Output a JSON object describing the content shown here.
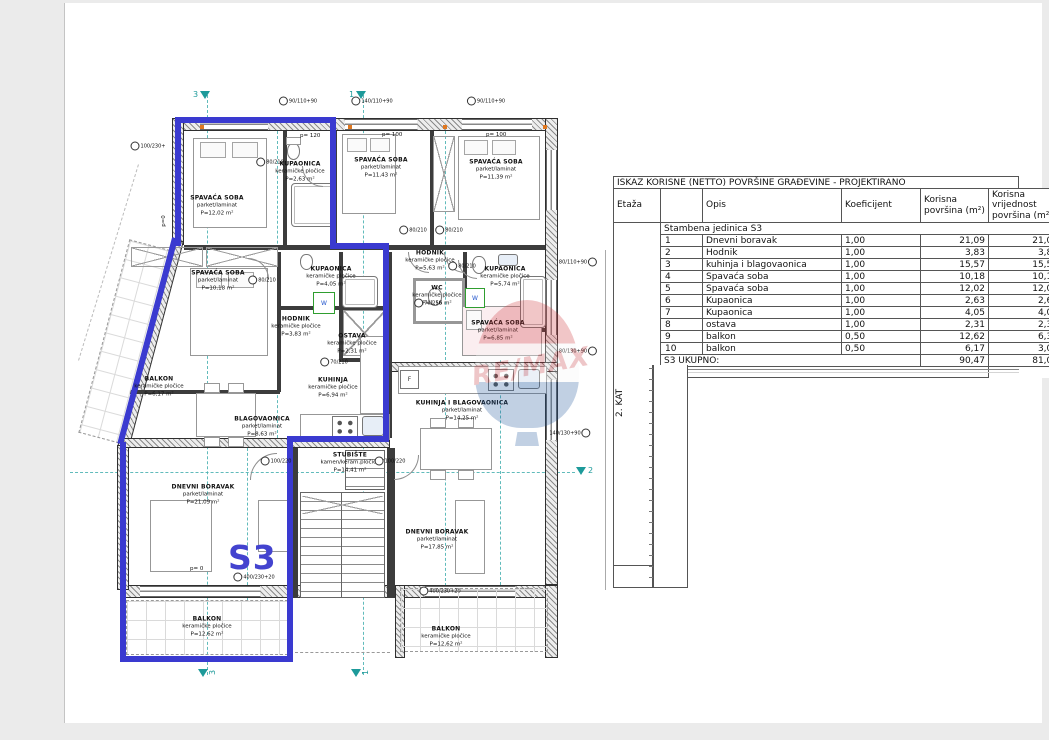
{
  "plan": {
    "unit_label": "S3",
    "markers": {
      "n3": "3",
      "n1": "1",
      "n2": "2"
    },
    "watermark": {
      "text": "RE/MAX"
    },
    "appliances": {
      "washer": "W",
      "fridge": "F"
    },
    "rooms": [
      {
        "name": "SPAVAĆA SOBA",
        "material": "parket/laminat",
        "area": "P=12,02 m²"
      },
      {
        "name": "KUPAONICA",
        "material": "keramičke pločice",
        "area": "P=2,63 m²"
      },
      {
        "name": "SPAVAĆA SOBA",
        "material": "parket/laminat",
        "area": "P=11,43 m²"
      },
      {
        "name": "SPAVAĆA SOBA",
        "material": "parket/laminat",
        "area": "P=11,39 m²"
      },
      {
        "name": "SPAVAĆA SOBA",
        "material": "parket/laminat",
        "area": "P=10,18 m²"
      },
      {
        "name": "HODNIK",
        "material": "keramičke pločice",
        "area": "P=5,63 m²"
      },
      {
        "name": "KUPAONICA",
        "material": "keramičke pločice",
        "area": "P=5,74 m²"
      },
      {
        "name": "KUPAONICA",
        "material": "keramičke pločice",
        "area": "P=4,05 m²"
      },
      {
        "name": "WC",
        "material": "keramičke pločice",
        "area": "P=1,56 m²"
      },
      {
        "name": "HODNIK",
        "material": "keramičke pločice",
        "area": "P=3,83 m²"
      },
      {
        "name": "OSTAVA",
        "material": "keramičke pločice",
        "area": "P=2,31 m²"
      },
      {
        "name": "SPAVAĆA SOBA",
        "material": "parket/laminat",
        "area": "P=6,85 m²"
      },
      {
        "name": "KUHINJA",
        "material": "keramičke pločice",
        "area": "P=6,94 m²"
      },
      {
        "name": "BALKON",
        "material": "keramičke pločice",
        "area": "P=6,17 m²"
      },
      {
        "name": "BLAGOVAONICA",
        "material": "parket/laminat",
        "area": "P=8,63 m²"
      },
      {
        "name": "KUHINJA I BLAGOVAONICA",
        "material": "parket/laminat",
        "area": "P=14,25 m²"
      },
      {
        "name": "STUBIŠTE",
        "material": "kamen/keram.pločice",
        "area": "P=14,41 m²"
      },
      {
        "name": "DNEVNI BORAVAK",
        "material": "parket/laminat",
        "area": "P=21,09 m²"
      },
      {
        "name": "DNEVNI BORAVAK",
        "material": "parket/laminat",
        "area": "P=17,85 m²"
      },
      {
        "name": "BALKON",
        "material": "keramičke pločice",
        "area": "P=12,62 m²"
      },
      {
        "name": "BALKON",
        "material": "keramičke pločice",
        "area": "P=12,62 m²"
      }
    ],
    "callouts": [
      "80/210",
      "100/230+",
      "90/110+90",
      "140/110+90",
      "90/110+90",
      "80/210",
      "80/210",
      "80/210",
      "70/210",
      "80/210",
      "70/210",
      "100/220",
      "100/220",
      "80/110+90",
      "80/130+90",
      "140/130+90",
      "400/230+20",
      "400/230+20"
    ],
    "parapets": [
      "p= 120",
      "p= 100",
      "p= 100",
      "p=0",
      "p= 0"
    ]
  },
  "table": {
    "title": "ISKAZ KORISNE (NETTO) POVRŠINE GRAĐEVINE - PROJEKTIRANO",
    "columns": [
      "Etaža",
      "",
      "Opis",
      "Koeficijent",
      "Korisna površina (m²)",
      "Korisna vrijednost površina (m²)"
    ],
    "floor_label": "2. KAT",
    "group_label": "Stambena jedinica S3",
    "rows": [
      {
        "num": "1",
        "opis": "Dnevni boravak",
        "koef": "1,00",
        "povrsina": "21,09",
        "vrijednost": "21,09"
      },
      {
        "num": "2",
        "opis": "Hodnik",
        "koef": "1,00",
        "povrsina": "3,83",
        "vrijednost": "3,83"
      },
      {
        "num": "3",
        "opis": "kuhinja  i blagovaonica",
        "koef": "1,00",
        "povrsina": "15,57",
        "vrijednost": "15,57"
      },
      {
        "num": "4",
        "opis": "Spavaća soba",
        "koef": "1,00",
        "povrsina": "10,18",
        "vrijednost": "10,18"
      },
      {
        "num": "5",
        "opis": "Spavaća soba",
        "koef": "1,00",
        "povrsina": "12,02",
        "vrijednost": "12,02"
      },
      {
        "num": "6",
        "opis": "Kupaonica",
        "koef": "1,00",
        "povrsina": "2,63",
        "vrijednost": "2,63"
      },
      {
        "num": "7",
        "opis": "Kupaonica",
        "koef": "1,00",
        "povrsina": "4,05",
        "vrijednost": "4,05"
      },
      {
        "num": "8",
        "opis": "ostava",
        "koef": "1,00",
        "povrsina": "2,31",
        "vrijednost": "2,31"
      },
      {
        "num": "9",
        "opis": "balkon",
        "koef": "0,50",
        "povrsina": "12,62",
        "vrijednost": "6,31"
      },
      {
        "num": "10",
        "opis": "balkon",
        "koef": "0,50",
        "povrsina": "6,17",
        "vrijednost": "3,09"
      }
    ],
    "total_label": "S3 UKUPNO:",
    "total_povrsina": "90,47",
    "total_vrijednost": "81,08"
  }
}
